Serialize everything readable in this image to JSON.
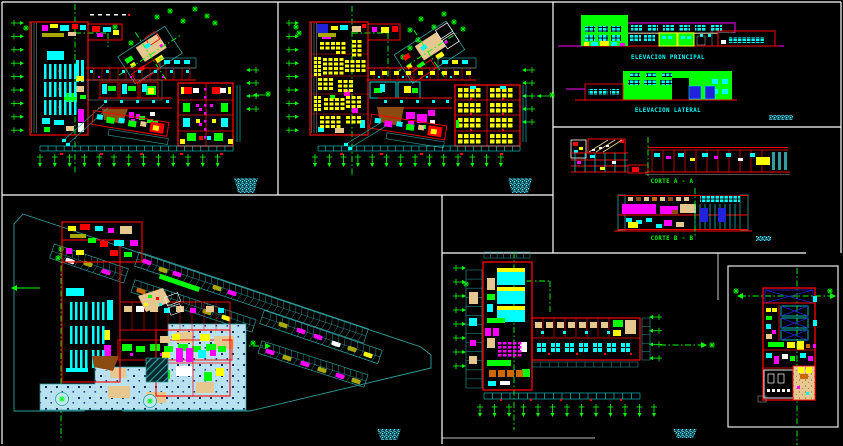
{
  "sheet": {
    "background": "#000000",
    "frame_color": "#ffffff"
  },
  "palette": {
    "background": "#000000",
    "white": "#ffffff",
    "green": "#00ff00",
    "cyan": "#00ffff",
    "red": "#ff0000",
    "magenta": "#ff00ff",
    "yellow": "#ffff00",
    "blue": "#2222dd",
    "teal": "#2f9e9e",
    "sand": "#e6c78f",
    "brown": "#8b4a10",
    "olive": "#a8a800",
    "pale_blue": "#b9e2f1",
    "gray": "#9a9a9a",
    "orange": "#cc6a00"
  },
  "panels": {
    "elevations": {
      "principal_label": "ELEVACION PRINCIPAL",
      "lateral_label": "ELEVACION LATERAL"
    },
    "sections": {
      "a_label": "CORTE A - A",
      "b_label": "CORTE B - B"
    }
  }
}
